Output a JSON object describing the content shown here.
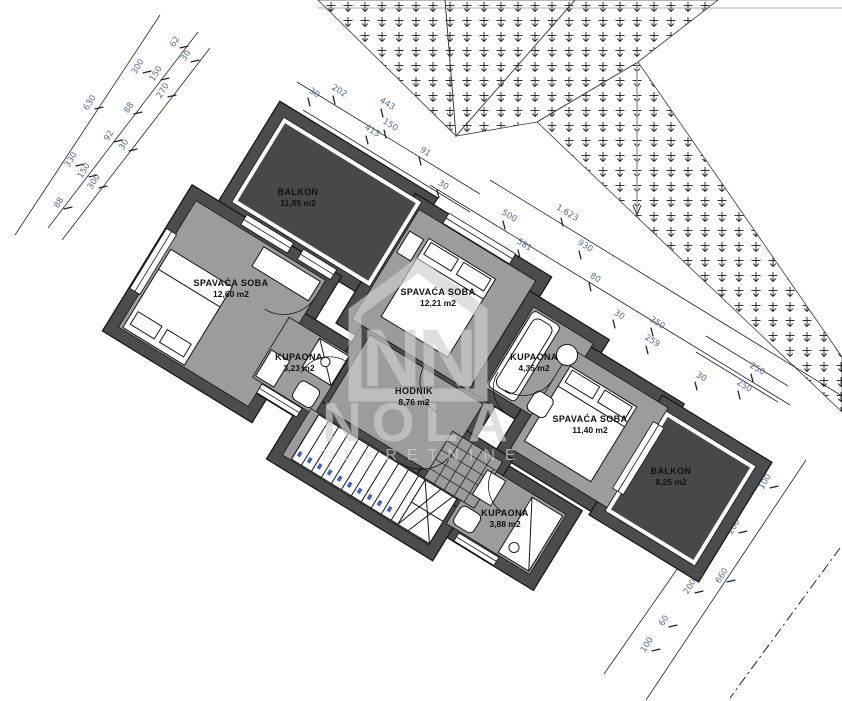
{
  "drawing": {
    "type": "floor-plan",
    "language": "hr"
  },
  "watermark": {
    "monogram": "NN",
    "brand": "NOLA",
    "subtitle": "NEKRETNINE"
  },
  "colors": {
    "wall": "#4c4c4c",
    "floor": "#9c9c9c",
    "balcony": "#484848",
    "fixture": "#ffffff",
    "stair_field": "#ededed",
    "dim_text": "#5b6b94",
    "line": "#1c1c1c",
    "watermark": "#cfcfcf",
    "step_mark": "#3f5fd0",
    "top_rule": "#cccccc",
    "faint_line": "#9a9a9a"
  },
  "rooms": [
    {
      "id": "balkon-1",
      "name": "BALKON",
      "area": "11,85 m2",
      "label": {
        "x": 298,
        "y": 198
      }
    },
    {
      "id": "spavaca-soba-1",
      "name": "SPAVAĆA SOBA",
      "area": "12,60 m2",
      "label": {
        "x": 231,
        "y": 289
      }
    },
    {
      "id": "spavaca-soba-2",
      "name": "SPAVAĆA SOBA",
      "area": "12,21 m2",
      "label": {
        "x": 438,
        "y": 298
      }
    },
    {
      "id": "kupaona-1",
      "name": "KUPAONA",
      "area": "3,23 m2",
      "label": {
        "x": 299,
        "y": 363
      }
    },
    {
      "id": "hodnik",
      "name": "HODNIK",
      "area": "8,76 m2",
      "label": {
        "x": 414,
        "y": 397
      }
    },
    {
      "id": "kupaona-2",
      "name": "KUPAONA",
      "area": "4,35 m2",
      "label": {
        "x": 534,
        "y": 363
      }
    },
    {
      "id": "spavaca-soba-3",
      "name": "SPAVAĆA SOBA",
      "area": "11,40 m2",
      "label": {
        "x": 590,
        "y": 425
      }
    },
    {
      "id": "balkon-2",
      "name": "BALKON",
      "area": "8,25 m2",
      "label": {
        "x": 671,
        "y": 477
      }
    },
    {
      "id": "kupaona-3",
      "name": "KUPAONA",
      "area": "3,88 m2",
      "label": {
        "x": 505,
        "y": 519
      }
    }
  ],
  "dimension_labels": [
    {
      "v": "630",
      "x": 92,
      "y": 104,
      "r": -58
    },
    {
      "v": "330",
      "x": 73,
      "y": 161,
      "r": -58
    },
    {
      "v": "88",
      "x": 61,
      "y": 204,
      "r": -58
    },
    {
      "v": "300",
      "x": 140,
      "y": 68,
      "r": -58
    },
    {
      "v": "150",
      "x": 158,
      "y": 75,
      "r": -58
    },
    {
      "v": "62",
      "x": 177,
      "y": 43,
      "r": -58
    },
    {
      "v": "30",
      "x": 188,
      "y": 57,
      "r": -58
    },
    {
      "v": "270",
      "x": 165,
      "y": 92,
      "r": -58
    },
    {
      "v": "88",
      "x": 131,
      "y": 109,
      "r": -58
    },
    {
      "v": "92",
      "x": 111,
      "y": 137,
      "r": -58
    },
    {
      "v": "30",
      "x": 126,
      "y": 146,
      "r": -58
    },
    {
      "v": "150",
      "x": 86,
      "y": 172,
      "r": -58
    },
    {
      "v": "300",
      "x": 96,
      "y": 183,
      "r": -58
    },
    {
      "v": "30",
      "x": 313,
      "y": 95,
      "r": 31.5
    },
    {
      "v": "202",
      "x": 338,
      "y": 93,
      "r": 31.5
    },
    {
      "v": "443",
      "x": 386,
      "y": 106,
      "r": 31.5
    },
    {
      "v": "413",
      "x": 371,
      "y": 133,
      "r": 31.5
    },
    {
      "v": "150",
      "x": 389,
      "y": 127,
      "r": 31.5
    },
    {
      "v": "91",
      "x": 424,
      "y": 154,
      "r": 31.5
    },
    {
      "v": "30",
      "x": 442,
      "y": 187,
      "r": 31.5
    },
    {
      "v": "500",
      "x": 508,
      "y": 218,
      "r": 31.5
    },
    {
      "v": "1.623",
      "x": 566,
      "y": 215,
      "r": 31.5
    },
    {
      "v": "581",
      "x": 523,
      "y": 247,
      "r": 31.5
    },
    {
      "v": "930",
      "x": 584,
      "y": 248,
      "r": 31.5
    },
    {
      "v": "80",
      "x": 594,
      "y": 280,
      "r": 31.5
    },
    {
      "v": "30",
      "x": 618,
      "y": 317,
      "r": 31.5
    },
    {
      "v": "350",
      "x": 656,
      "y": 325,
      "r": 31.5
    },
    {
      "v": "259",
      "x": 651,
      "y": 343,
      "r": 31.5
    },
    {
      "v": "30",
      "x": 700,
      "y": 379,
      "r": 31.5
    },
    {
      "v": "250",
      "x": 756,
      "y": 371,
      "r": 31.5
    },
    {
      "v": "250",
      "x": 743,
      "y": 388,
      "r": 31.5
    },
    {
      "v": "30",
      "x": 750,
      "y": 471,
      "r": -58
    },
    {
      "v": "100",
      "x": 767,
      "y": 483,
      "r": -58
    },
    {
      "v": "200",
      "x": 736,
      "y": 528,
      "r": -58
    },
    {
      "v": "600",
      "x": 689,
      "y": 553,
      "r": -58
    },
    {
      "v": "660",
      "x": 724,
      "y": 577,
      "r": -58
    },
    {
      "v": "200",
      "x": 692,
      "y": 588,
      "r": -58
    },
    {
      "v": "60",
      "x": 666,
      "y": 622,
      "r": -58
    },
    {
      "v": "100",
      "x": 649,
      "y": 646,
      "r": -58
    }
  ]
}
